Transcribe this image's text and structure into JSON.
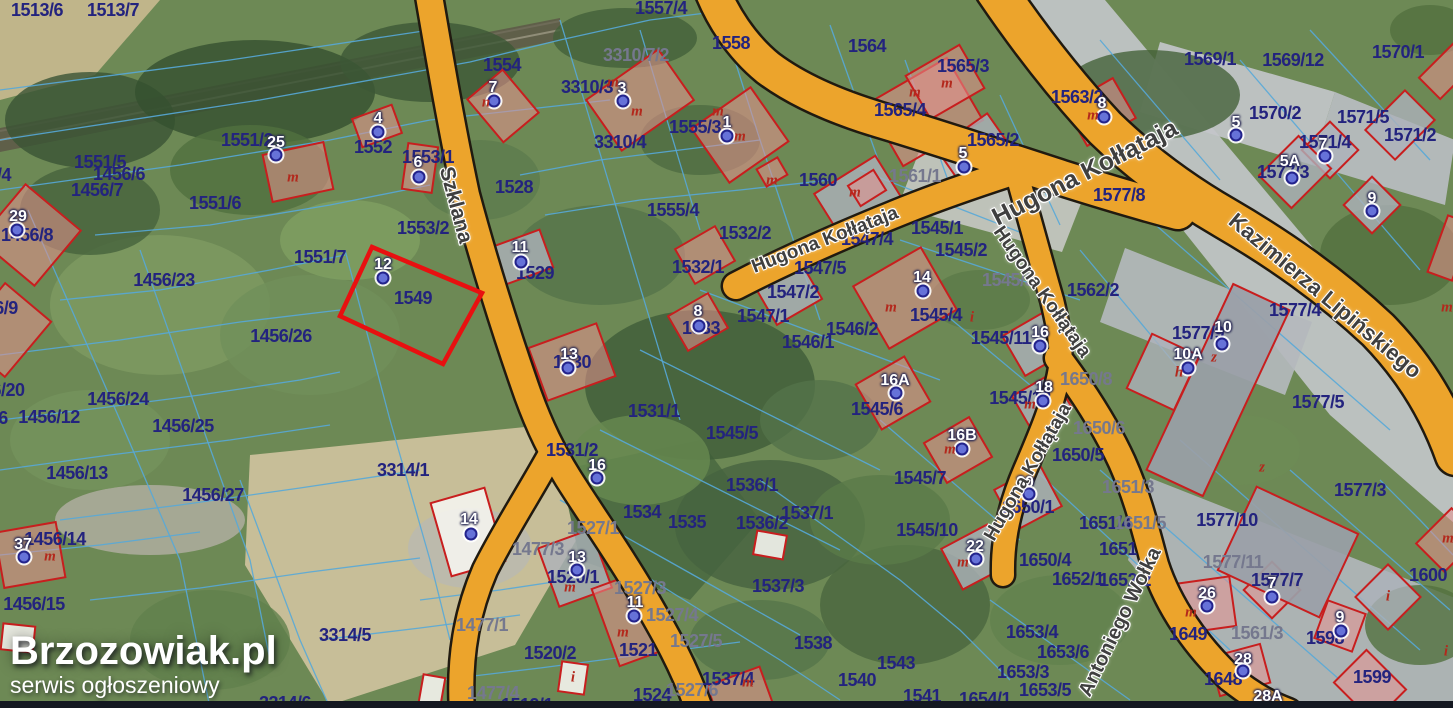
{
  "canvas": {
    "width": 1453,
    "height": 708
  },
  "watermark": {
    "title": "Brzozowiak.pl",
    "subtitle": "serwis ogłoszeniowy"
  },
  "colors": {
    "road": "#eca42c",
    "road_outline": "#201a10",
    "boundary": "#56a8d8",
    "parcel_text": "#23237e",
    "parcel_text_muted": "#75788e",
    "building_outline": "#c81e1e",
    "marker_dot": "#6672d8",
    "street_text": "#3f3f3f",
    "highlight": "#e81010",
    "watermark_text": "#ffffff"
  },
  "highlight": {
    "parcel": "1549",
    "color": "#e81010",
    "points": [
      [
        372,
        247
      ],
      [
        482,
        293
      ],
      [
        443,
        364
      ],
      [
        340,
        316
      ]
    ]
  },
  "streets": [
    {
      "name": "Szklana",
      "x": 456,
      "y": 205,
      "rot": 75,
      "size": 21
    },
    {
      "name": "Hugona Kołłątaja",
      "x": 825,
      "y": 240,
      "rot": -21,
      "size": 19
    },
    {
      "name": "Hugona Kołłątaja",
      "x": 1085,
      "y": 173,
      "rot": -27,
      "size": 25
    },
    {
      "name": "Hugona Kołłątaja",
      "x": 1042,
      "y": 292,
      "rot": 55,
      "size": 19
    },
    {
      "name": "Hugona Kołłątaja",
      "x": 1028,
      "y": 472,
      "rot": -60,
      "size": 19
    },
    {
      "name": "Kazimierza Lipińskiego",
      "x": 1325,
      "y": 296,
      "rot": 40,
      "size": 22
    },
    {
      "name": "Antoniego Wołka",
      "x": 1120,
      "y": 622,
      "rot": -64,
      "size": 20
    }
  ],
  "parcels": [
    {
      "t": "1513/6",
      "x": 37,
      "y": 10
    },
    {
      "t": "1513/7",
      "x": 113,
      "y": 10
    },
    {
      "t": "1551/2",
      "x": 247,
      "y": 140
    },
    {
      "t": "1552",
      "x": 373,
      "y": 147
    },
    {
      "t": "1553/1",
      "x": 428,
      "y": 157
    },
    {
      "t": "1554",
      "x": 502,
      "y": 65
    },
    {
      "t": "1557/4",
      "x": 661,
      "y": 8
    },
    {
      "t": "1558",
      "x": 731,
      "y": 43
    },
    {
      "t": "1564",
      "x": 867,
      "y": 46
    },
    {
      "t": "3310/7/2",
      "x": 636,
      "y": 55,
      "muted": true
    },
    {
      "t": "3310/3",
      "x": 587,
      "y": 87
    },
    {
      "t": "1555/3",
      "x": 695,
      "y": 127
    },
    {
      "t": "3310/4",
      "x": 620,
      "y": 142
    },
    {
      "t": "1528",
      "x": 514,
      "y": 187
    },
    {
      "t": "1555/4",
      "x": 673,
      "y": 210
    },
    {
      "t": "1560",
      "x": 818,
      "y": 180
    },
    {
      "t": "1565/3",
      "x": 963,
      "y": 66
    },
    {
      "t": "1565/4",
      "x": 900,
      "y": 110
    },
    {
      "t": "1565/2",
      "x": 993,
      "y": 140
    },
    {
      "t": "1563/2",
      "x": 1077,
      "y": 97
    },
    {
      "t": "1561/1",
      "x": 915,
      "y": 176,
      "muted": true
    },
    {
      "t": "1569/1",
      "x": 1210,
      "y": 59
    },
    {
      "t": "1569/12",
      "x": 1293,
      "y": 60
    },
    {
      "t": "1570/1",
      "x": 1398,
      "y": 52
    },
    {
      "t": "1570/2",
      "x": 1275,
      "y": 113
    },
    {
      "t": "1571/5",
      "x": 1363,
      "y": 117
    },
    {
      "t": "1571/4",
      "x": 1325,
      "y": 142
    },
    {
      "t": "1571/2",
      "x": 1410,
      "y": 135
    },
    {
      "t": "1577/3",
      "x": 1283,
      "y": 172
    },
    {
      "t": "1577/8",
      "x": 1119,
      "y": 195
    },
    {
      "t": "1545/1",
      "x": 937,
      "y": 228
    },
    {
      "t": "1545/2",
      "x": 961,
      "y": 250
    },
    {
      "t": "1545/3",
      "x": 1008,
      "y": 280,
      "muted": true
    },
    {
      "t": "1547/4",
      "x": 867,
      "y": 239
    },
    {
      "t": "1547/5",
      "x": 820,
      "y": 268
    },
    {
      "t": "1547/2",
      "x": 793,
      "y": 292
    },
    {
      "t": "1547/1",
      "x": 763,
      "y": 316
    },
    {
      "t": "1546/2",
      "x": 852,
      "y": 329
    },
    {
      "t": "1546/1",
      "x": 808,
      "y": 342
    },
    {
      "t": "1532/2",
      "x": 745,
      "y": 233
    },
    {
      "t": "1532/1",
      "x": 698,
      "y": 267
    },
    {
      "t": "1529",
      "x": 535,
      "y": 273
    },
    {
      "t": "1533",
      "x": 701,
      "y": 328
    },
    {
      "t": "1530",
      "x": 572,
      "y": 362
    },
    {
      "t": "1531/1",
      "x": 654,
      "y": 411
    },
    {
      "t": "1531/2",
      "x": 572,
      "y": 450
    },
    {
      "t": "1545/5",
      "x": 732,
      "y": 433
    },
    {
      "t": "1545/6",
      "x": 877,
      "y": 409
    },
    {
      "t": "1545/7",
      "x": 920,
      "y": 478
    },
    {
      "t": "1545/4",
      "x": 936,
      "y": 315
    },
    {
      "t": "1545/11",
      "x": 1001,
      "y": 338
    },
    {
      "t": "1545/12",
      "x": 1020,
      "y": 398
    },
    {
      "t": "1562/2",
      "x": 1093,
      "y": 290
    },
    {
      "t": "1577/4",
      "x": 1295,
      "y": 310
    },
    {
      "t": "1577/9",
      "x": 1198,
      "y": 333
    },
    {
      "t": "1577/5",
      "x": 1318,
      "y": 402
    },
    {
      "t": "1650/8",
      "x": 1086,
      "y": 379,
      "muted": true
    },
    {
      "t": "1650/6",
      "x": 1099,
      "y": 428,
      "muted": true
    },
    {
      "t": "1650/5",
      "x": 1078,
      "y": 455
    },
    {
      "t": "1650/1",
      "x": 1028,
      "y": 507
    },
    {
      "t": "1650/4",
      "x": 1045,
      "y": 560
    },
    {
      "t": "1651/3",
      "x": 1128,
      "y": 487,
      "muted": true
    },
    {
      "t": "1651/4",
      "x": 1105,
      "y": 523
    },
    {
      "t": "1651/5",
      "x": 1140,
      "y": 523,
      "muted": true
    },
    {
      "t": "1651",
      "x": 1118,
      "y": 549
    },
    {
      "t": "1652/1",
      "x": 1078,
      "y": 579
    },
    {
      "t": "1652/2",
      "x": 1125,
      "y": 580
    },
    {
      "t": "1653/4",
      "x": 1032,
      "y": 632
    },
    {
      "t": "1653/6",
      "x": 1063,
      "y": 652
    },
    {
      "t": "1653/3",
      "x": 1023,
      "y": 672
    },
    {
      "t": "1653/5",
      "x": 1045,
      "y": 690
    },
    {
      "t": "1654/1",
      "x": 985,
      "y": 699
    },
    {
      "t": "1561/3",
      "x": 1257,
      "y": 633,
      "muted": true
    },
    {
      "t": "1649",
      "x": 1188,
      "y": 634
    },
    {
      "t": "1577/10",
      "x": 1227,
      "y": 520
    },
    {
      "t": "1577/11",
      "x": 1233,
      "y": 562,
      "muted": true
    },
    {
      "t": "1577/7",
      "x": 1277,
      "y": 580
    },
    {
      "t": "1577/3",
      "x": 1360,
      "y": 490
    },
    {
      "t": "1598",
      "x": 1325,
      "y": 638
    },
    {
      "t": "1600",
      "x": 1428,
      "y": 575
    },
    {
      "t": "1648",
      "x": 1223,
      "y": 679
    },
    {
      "t": "1599",
      "x": 1372,
      "y": 677
    },
    {
      "t": "1551/5",
      "x": 100,
      "y": 162
    },
    {
      "t": "1456/6",
      "x": 119,
      "y": 174
    },
    {
      "t": "1456/7",
      "x": 97,
      "y": 190
    },
    {
      "t": "1551/6",
      "x": 215,
      "y": 203
    },
    {
      "t": "1551/7",
      "x": 320,
      "y": 257
    },
    {
      "t": "1553/2",
      "x": 423,
      "y": 228
    },
    {
      "t": "1549",
      "x": 413,
      "y": 298
    },
    {
      "t": "1456/23",
      "x": 164,
      "y": 280
    },
    {
      "t": "1456/26",
      "x": 281,
      "y": 336
    },
    {
      "t": "1456/24",
      "x": 118,
      "y": 399
    },
    {
      "t": "1456/12",
      "x": 49,
      "y": 417
    },
    {
      "t": "1456/25",
      "x": 183,
      "y": 426
    },
    {
      "t": "1456/8",
      "x": 27,
      "y": 235
    },
    {
      "t": "6/9",
      "x": 6,
      "y": 308
    },
    {
      "t": "6/20",
      "x": 8,
      "y": 390
    },
    {
      "t": "6",
      "x": 3,
      "y": 418
    },
    {
      "t": "/4",
      "x": 4,
      "y": 175
    },
    {
      "t": "1456/13",
      "x": 77,
      "y": 473
    },
    {
      "t": "1456/27",
      "x": 213,
      "y": 495
    },
    {
      "t": "1456/14",
      "x": 55,
      "y": 539
    },
    {
      "t": "1456/15",
      "x": 34,
      "y": 604
    },
    {
      "t": "3314/1",
      "x": 403,
      "y": 470
    },
    {
      "t": "3314/5",
      "x": 345,
      "y": 635
    },
    {
      "t": "3314/6",
      "x": 285,
      "y": 703
    },
    {
      "t": "1477/3",
      "x": 538,
      "y": 549,
      "muted": true
    },
    {
      "t": "1477/1",
      "x": 482,
      "y": 625,
      "muted": true
    },
    {
      "t": "1477/4",
      "x": 493,
      "y": 693,
      "muted": true
    },
    {
      "t": "1520/1",
      "x": 573,
      "y": 577
    },
    {
      "t": "1520/2",
      "x": 550,
      "y": 653
    },
    {
      "t": "1521",
      "x": 638,
      "y": 650
    },
    {
      "t": "1524",
      "x": 652,
      "y": 695
    },
    {
      "t": "1527/1",
      "x": 593,
      "y": 528,
      "muted": true
    },
    {
      "t": "1527/3",
      "x": 640,
      "y": 588,
      "muted": true
    },
    {
      "t": "1527/4",
      "x": 672,
      "y": 615,
      "muted": true
    },
    {
      "t": "1527/5",
      "x": 696,
      "y": 641,
      "muted": true
    },
    {
      "t": "1527/6",
      "x": 692,
      "y": 690,
      "muted": true
    },
    {
      "t": "1519/1",
      "x": 527,
      "y": 705
    },
    {
      "t": "1534",
      "x": 642,
      "y": 512
    },
    {
      "t": "1535",
      "x": 687,
      "y": 522
    },
    {
      "t": "1536/1",
      "x": 752,
      "y": 485
    },
    {
      "t": "1536/2",
      "x": 762,
      "y": 523
    },
    {
      "t": "1537/1",
      "x": 807,
      "y": 513
    },
    {
      "t": "1537/3",
      "x": 778,
      "y": 586
    },
    {
      "t": "1537/4",
      "x": 728,
      "y": 679
    },
    {
      "t": "1538",
      "x": 813,
      "y": 643
    },
    {
      "t": "1543",
      "x": 896,
      "y": 663
    },
    {
      "t": "1540",
      "x": 857,
      "y": 680
    },
    {
      "t": "1541",
      "x": 922,
      "y": 696
    },
    {
      "t": "1545/10",
      "x": 927,
      "y": 530
    }
  ],
  "markers": [
    {
      "t": "25",
      "x": 276,
      "y": 143,
      "dx": 276,
      "dy": 155
    },
    {
      "t": "4",
      "x": 378,
      "y": 119,
      "dx": 378,
      "dy": 132
    },
    {
      "t": "7",
      "x": 493,
      "y": 88,
      "dx": 494,
      "dy": 101
    },
    {
      "t": "6",
      "x": 418,
      "y": 163,
      "dx": 419,
      "dy": 177
    },
    {
      "t": "3",
      "x": 622,
      "y": 89,
      "dx": 623,
      "dy": 101
    },
    {
      "t": "1",
      "x": 727,
      "y": 123,
      "dx": 727,
      "dy": 136
    },
    {
      "t": "29",
      "x": 18,
      "y": 217,
      "dx": 17,
      "dy": 230
    },
    {
      "t": "12",
      "x": 383,
      "y": 265,
      "dx": 383,
      "dy": 278
    },
    {
      "t": "11",
      "x": 520,
      "y": 248,
      "dx": 521,
      "dy": 262
    },
    {
      "t": "13",
      "x": 569,
      "y": 355,
      "dx": 568,
      "dy": 368
    },
    {
      "t": "16",
      "x": 597,
      "y": 466,
      "dx": 597,
      "dy": 478
    },
    {
      "t": "8",
      "x": 698,
      "y": 312,
      "dx": 699,
      "dy": 326
    },
    {
      "t": "5",
      "x": 963,
      "y": 154,
      "dx": 964,
      "dy": 167
    },
    {
      "t": "8",
      "x": 1102,
      "y": 104,
      "dx": 1104,
      "dy": 117
    },
    {
      "t": "5",
      "x": 1236,
      "y": 123,
      "dx": 1236,
      "dy": 135
    },
    {
      "t": "7",
      "x": 1323,
      "y": 145,
      "dx": 1325,
      "dy": 156
    },
    {
      "t": "5A",
      "x": 1290,
      "y": 162,
      "dx": 1292,
      "dy": 178
    },
    {
      "t": "9",
      "x": 1372,
      "y": 199,
      "dx": 1372,
      "dy": 211
    },
    {
      "t": "14",
      "x": 922,
      "y": 278,
      "dx": 923,
      "dy": 291
    },
    {
      "t": "16A",
      "x": 895,
      "y": 381,
      "dx": 896,
      "dy": 393
    },
    {
      "t": "16B",
      "x": 962,
      "y": 436,
      "dx": 962,
      "dy": 449
    },
    {
      "t": "16",
      "x": 1040,
      "y": 333,
      "dx": 1040,
      "dy": 346
    },
    {
      "t": "18",
      "x": 1044,
      "y": 388,
      "dx": 1043,
      "dy": 401
    },
    {
      "t": "20",
      "x": 1025,
      "y": 483,
      "dx": 1029,
      "dy": 494
    },
    {
      "t": "22",
      "x": 975,
      "y": 547,
      "dx": 976,
      "dy": 559
    },
    {
      "t": "26",
      "x": 1207,
      "y": 594,
      "dx": 1207,
      "dy": 606
    },
    {
      "t": "10",
      "x": 1223,
      "y": 328,
      "dx": 1222,
      "dy": 344
    },
    {
      "t": "10A",
      "x": 1188,
      "y": 355,
      "dx": 1188,
      "dy": 368
    },
    {
      "t": "37",
      "x": 23,
      "y": 545,
      "dx": 24,
      "dy": 557
    },
    {
      "t": "14",
      "x": 469,
      "y": 520,
      "dx": 471,
      "dy": 534
    },
    {
      "t": "13",
      "x": 577,
      "y": 558,
      "dx": 577,
      "dy": 570
    },
    {
      "t": "11",
      "x": 635,
      "y": 603,
      "dx": 634,
      "dy": 616
    },
    {
      "t": "7",
      "x": 1272,
      "y": 584,
      "dx": 1272,
      "dy": 597
    },
    {
      "t": "9",
      "x": 1340,
      "y": 618,
      "dx": 1341,
      "dy": 631
    },
    {
      "t": "28",
      "x": 1243,
      "y": 660,
      "dx": 1243,
      "dy": 671
    },
    {
      "t": "28A",
      "x": 1268,
      "y": 697,
      "dx": null,
      "dy": null
    }
  ],
  "red_letters": [
    {
      "t": "m",
      "x": 293,
      "y": 178
    },
    {
      "t": "m",
      "x": 613,
      "y": 83
    },
    {
      "t": "m",
      "x": 637,
      "y": 112
    },
    {
      "t": "m",
      "x": 718,
      "y": 112
    },
    {
      "t": "m",
      "x": 740,
      "y": 137
    },
    {
      "t": "m",
      "x": 772,
      "y": 181
    },
    {
      "t": "m",
      "x": 915,
      "y": 93
    },
    {
      "t": "m",
      "x": 947,
      "y": 84
    },
    {
      "t": "m",
      "x": 1093,
      "y": 116
    },
    {
      "t": "m",
      "x": 855,
      "y": 193
    },
    {
      "t": "n",
      "x": 486,
      "y": 103
    },
    {
      "t": "m",
      "x": 891,
      "y": 308
    },
    {
      "t": "m",
      "x": 950,
      "y": 450
    },
    {
      "t": "m",
      "x": 1030,
      "y": 405
    },
    {
      "t": "m",
      "x": 963,
      "y": 563
    },
    {
      "t": "m",
      "x": 1191,
      "y": 613
    },
    {
      "t": "m",
      "x": 570,
      "y": 588
    },
    {
      "t": "m",
      "x": 623,
      "y": 633
    },
    {
      "t": "m",
      "x": 50,
      "y": 557
    },
    {
      "t": "m",
      "x": 748,
      "y": 683
    },
    {
      "t": "h",
      "x": 1179,
      "y": 373
    },
    {
      "t": "z",
      "x": 1214,
      "y": 358
    },
    {
      "t": "z",
      "x": 1262,
      "y": 468
    },
    {
      "t": "i",
      "x": 1388,
      "y": 597
    },
    {
      "t": "i",
      "x": 1446,
      "y": 652
    },
    {
      "t": "i",
      "x": 573,
      "y": 678
    },
    {
      "t": "i",
      "x": 972,
      "y": 318
    },
    {
      "t": "m",
      "x": 1447,
      "y": 308
    },
    {
      "t": "m",
      "x": 1448,
      "y": 539
    }
  ]
}
